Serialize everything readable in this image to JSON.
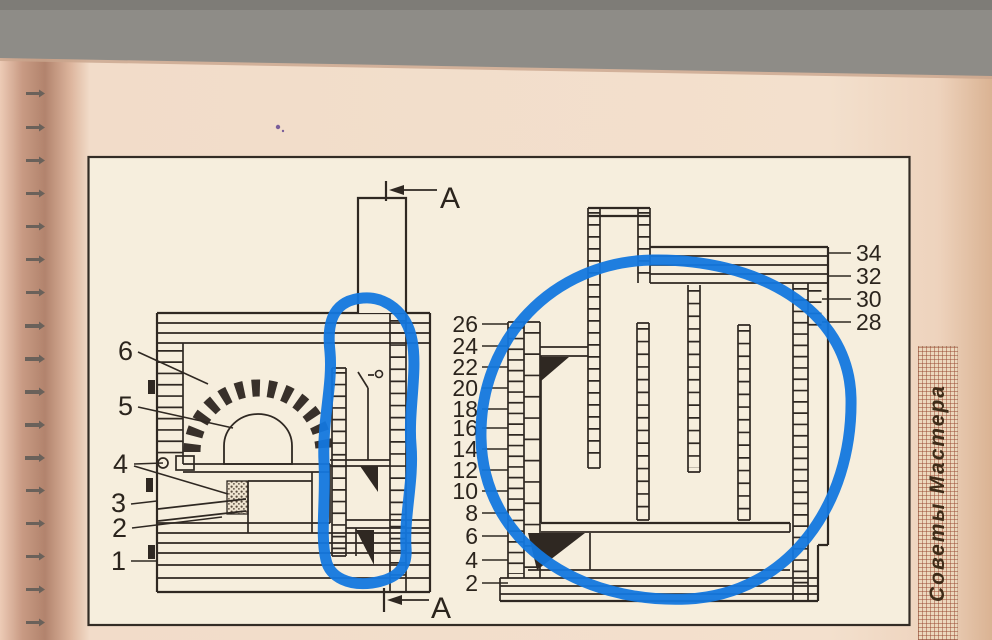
{
  "banner": {
    "text": "Советы Мастера"
  },
  "diagram": {
    "section_label_top": "А",
    "section_label_bottom": "А",
    "part_labels": [
      {
        "text": "6"
      },
      {
        "text": "5"
      },
      {
        "text": "4"
      },
      {
        "text": "3"
      },
      {
        "text": "2"
      },
      {
        "text": "1"
      }
    ],
    "mid_course_labels": [
      {
        "text": "26"
      },
      {
        "text": "24"
      },
      {
        "text": "22"
      },
      {
        "text": "20"
      },
      {
        "text": "18"
      },
      {
        "text": "16"
      },
      {
        "text": "14"
      },
      {
        "text": "12"
      },
      {
        "text": "10"
      },
      {
        "text": "8"
      },
      {
        "text": "6"
      },
      {
        "text": "4"
      },
      {
        "text": "2"
      }
    ],
    "right_course_labels": [
      {
        "text": "34"
      },
      {
        "text": "32"
      },
      {
        "text": "30"
      },
      {
        "text": "28"
      }
    ]
  },
  "annotations": {
    "highlight_color": "#1377de",
    "shapes": [
      "middle-channel-blob",
      "right-section-ellipse"
    ]
  },
  "colors": {
    "paper_outer": "#f2dcc9",
    "paper_frame": "#f6eedd",
    "ink": "#2f2822",
    "scanner_strip": "#8e8c87",
    "banner_grid": "#994832"
  }
}
